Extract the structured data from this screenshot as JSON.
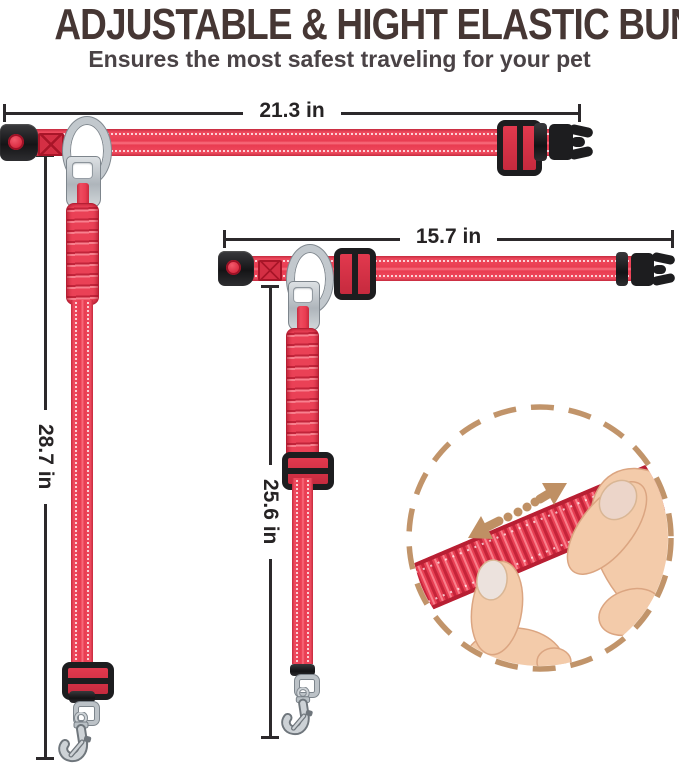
{
  "header": {
    "title": "ADJUSTABLE & HIGHT ELASTIC BUNGEE",
    "subtitle": "Ensures the most safest traveling for your pet"
  },
  "leashes": {
    "large": {
      "length_label": "21.3 in",
      "drop_label": "28.7 in"
    },
    "small": {
      "length_label": "15.7 in",
      "drop_label": "25.6 in"
    }
  },
  "icons": {
    "stretch_arrow": "double-headed-dashed-arrow",
    "inset": "bungee-stretch-demo-circle"
  },
  "colors": {
    "strap_red": "#e93c51",
    "strap_red_dark": "#c62a3e",
    "strap_red_light": "#f97f8d",
    "hardware_black": "#1d1d1f",
    "metal_silver": "#c2c8cd",
    "dimension_line": "#2c292b",
    "title_brown": "#463734",
    "subtitle_gray": "#4a4346",
    "accent_tan": "#c1946a",
    "skin_tone": "#f3cbaa"
  }
}
